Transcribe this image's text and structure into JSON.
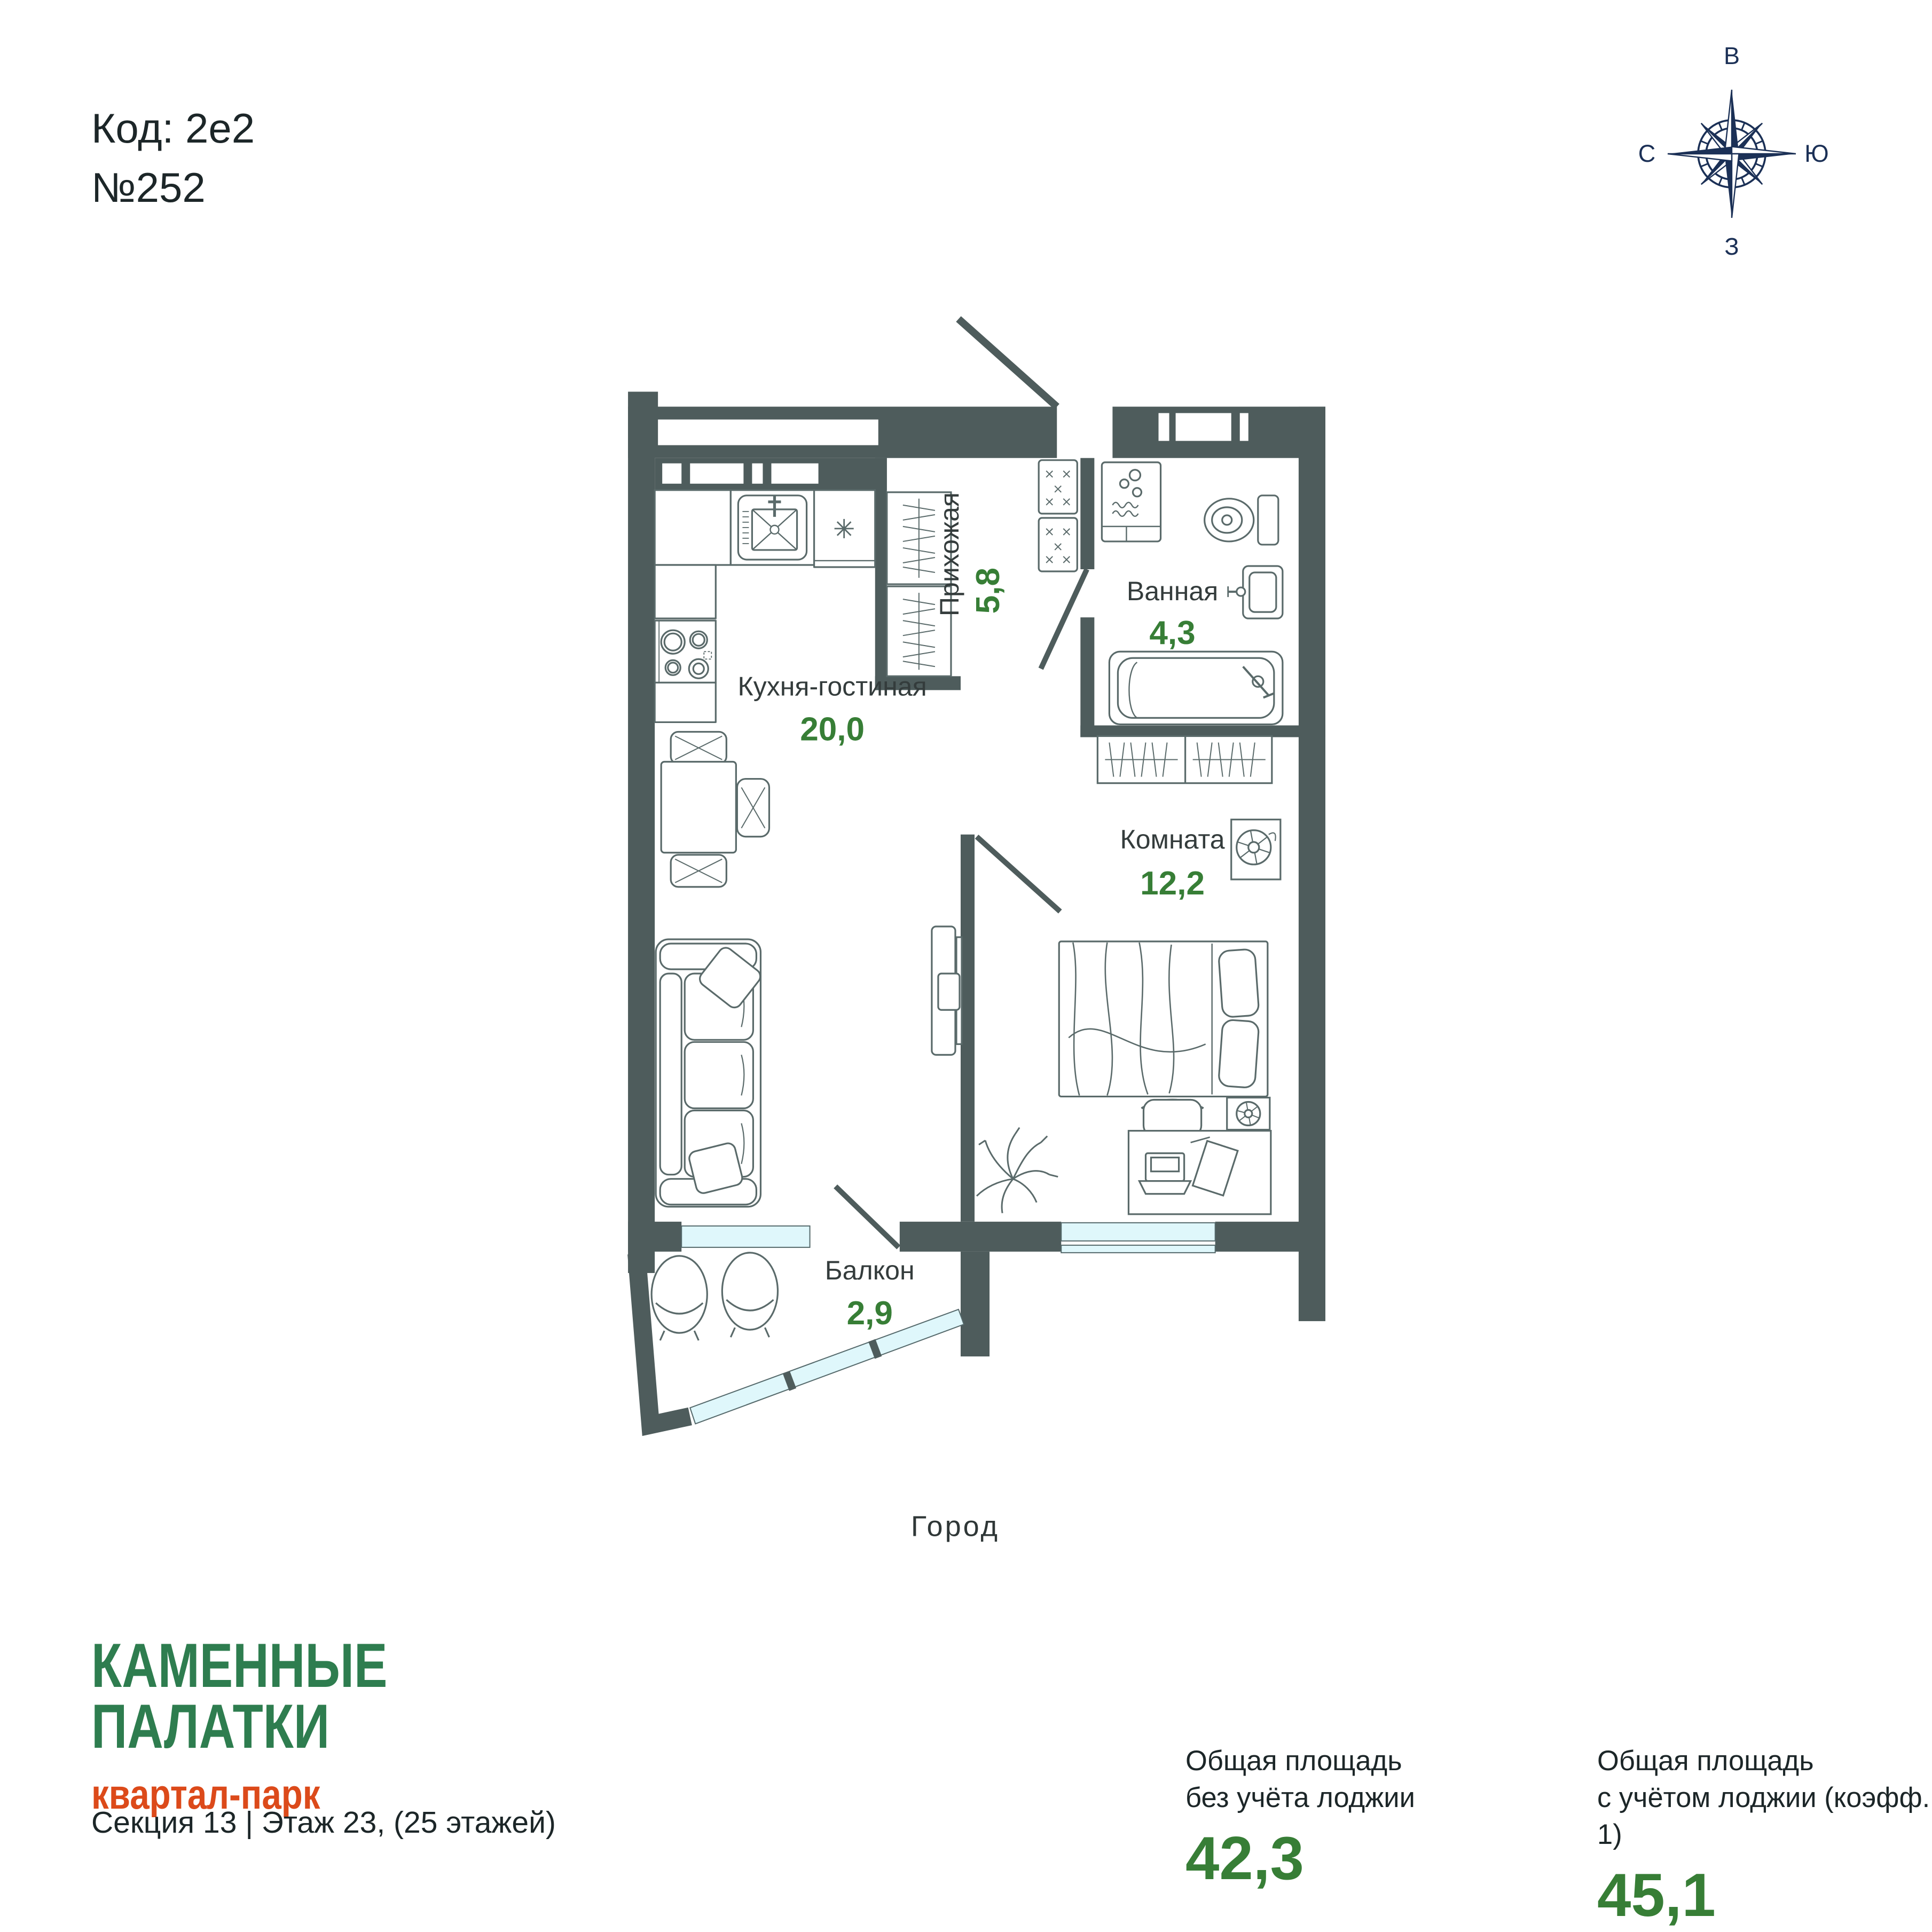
{
  "header": {
    "code_label": "Код: 2е2",
    "number": "№252"
  },
  "compass": {
    "top": "В",
    "right": "Ю",
    "bottom": "З",
    "left": "С"
  },
  "plan": {
    "rooms": [
      {
        "name": "Прихожая",
        "area": "5,8"
      },
      {
        "name": "Ванная",
        "area": "4,3"
      },
      {
        "name": "Кухня-гостиная",
        "area": "20,0"
      },
      {
        "name": "Комната",
        "area": "12,2"
      },
      {
        "name": "Балкон",
        "area": "2,9"
      }
    ],
    "view_label": "Город"
  },
  "footer": {
    "brand_line1": "КАМЕННЫЕ",
    "brand_line2": "ПАЛАТКИ",
    "brand_sub": "квартал-парк",
    "section_info": "Секция 13 | Этаж 23, (25 этажей)",
    "stats": [
      {
        "label_line1": "Общая площадь",
        "label_line2": "без учёта лоджии",
        "value": "42,3"
      },
      {
        "label_line1": "Общая площадь",
        "label_line2": "с учётом лоджии (коэфф. 1)",
        "value": "45,1"
      }
    ]
  },
  "colors": {
    "wall": "#4E5C5C",
    "area_green": "#377E36",
    "brand_green": "#2E7D4F",
    "brand_orange": "#DC4A1A",
    "window_glass": "#DFF7FB",
    "compass_navy": "#1B3056"
  }
}
